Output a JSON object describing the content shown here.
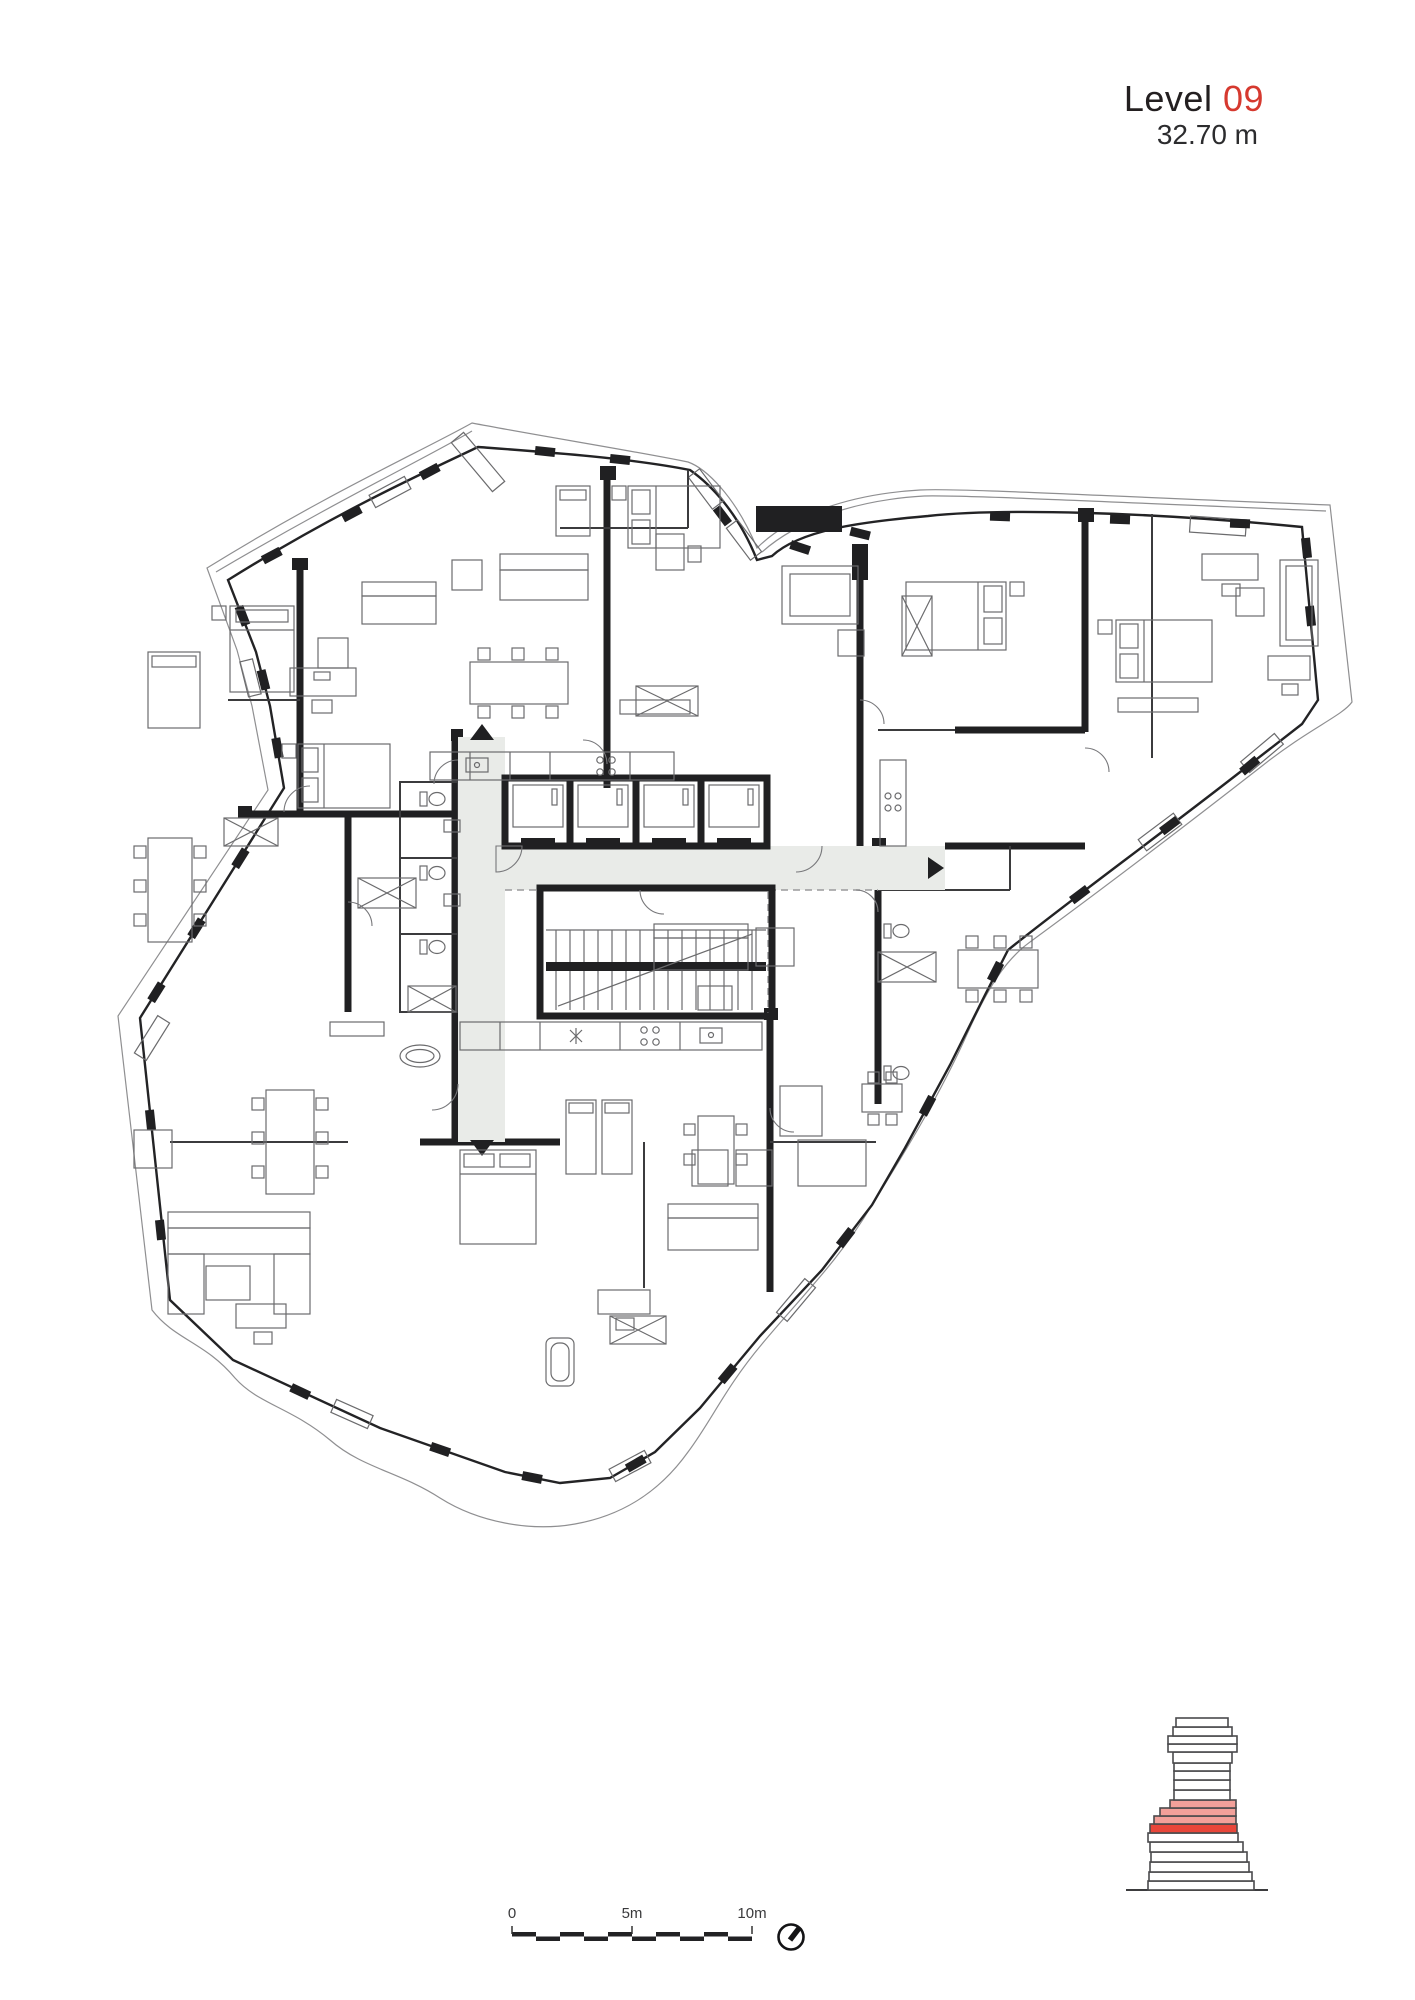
{
  "header": {
    "title_prefix": "Level",
    "level_number": "09",
    "elevation": "32.70 m"
  },
  "scale_bar": {
    "labels": [
      "0",
      "5m",
      "10m"
    ],
    "segments": 10,
    "meters_per_segment": 1
  },
  "north_indicator": {
    "glyph": "compass-needle-ne"
  },
  "floor_plan": {
    "elevator_count": 4,
    "corridor": "T-shaped gray circulation",
    "stair": "double-flight central staircase"
  },
  "building_section": {
    "highlighted_floor_count": 4,
    "current_floor_style": "solid red band"
  },
  "colors": {
    "accent": "#d6392f",
    "wall": "#202022",
    "corridor": "#e9ebe8",
    "section_outline": "#4a4a4c",
    "highlight": "#e8463a",
    "highlight_light": "#f2a09a"
  }
}
